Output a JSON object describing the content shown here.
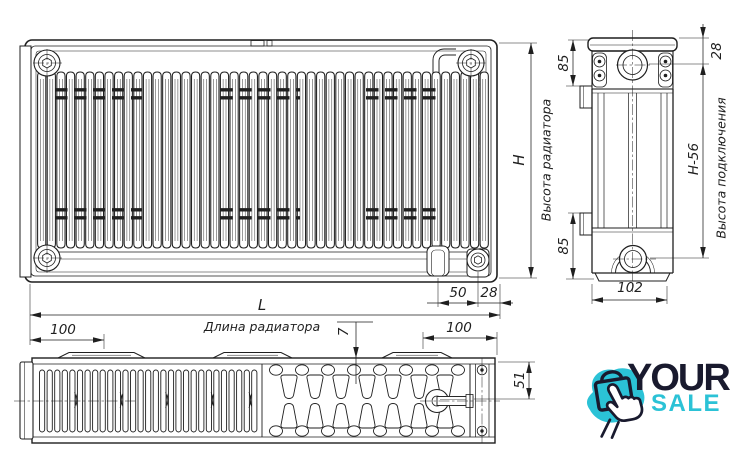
{
  "dims": {
    "H": "H",
    "L": "L",
    "h_minus_56": "H-56",
    "d85_top": "85",
    "d85_bottom": "85",
    "d28_side": "28",
    "d28_front": "28",
    "d50": "50",
    "d100_left": "100",
    "d100_right": "100",
    "d102": "102",
    "d51": "51",
    "d7": "7"
  },
  "labels": {
    "height_radiator": "Высота радиатора",
    "connection_height": "Высота подключения",
    "length_radiator": "Длина радиатора"
  },
  "logo": {
    "line1": "YOUR",
    "line2": "SALE"
  },
  "colors": {
    "line": "#1f1f1f",
    "teal": "#2bc2d6",
    "dark": "#191a2e"
  }
}
